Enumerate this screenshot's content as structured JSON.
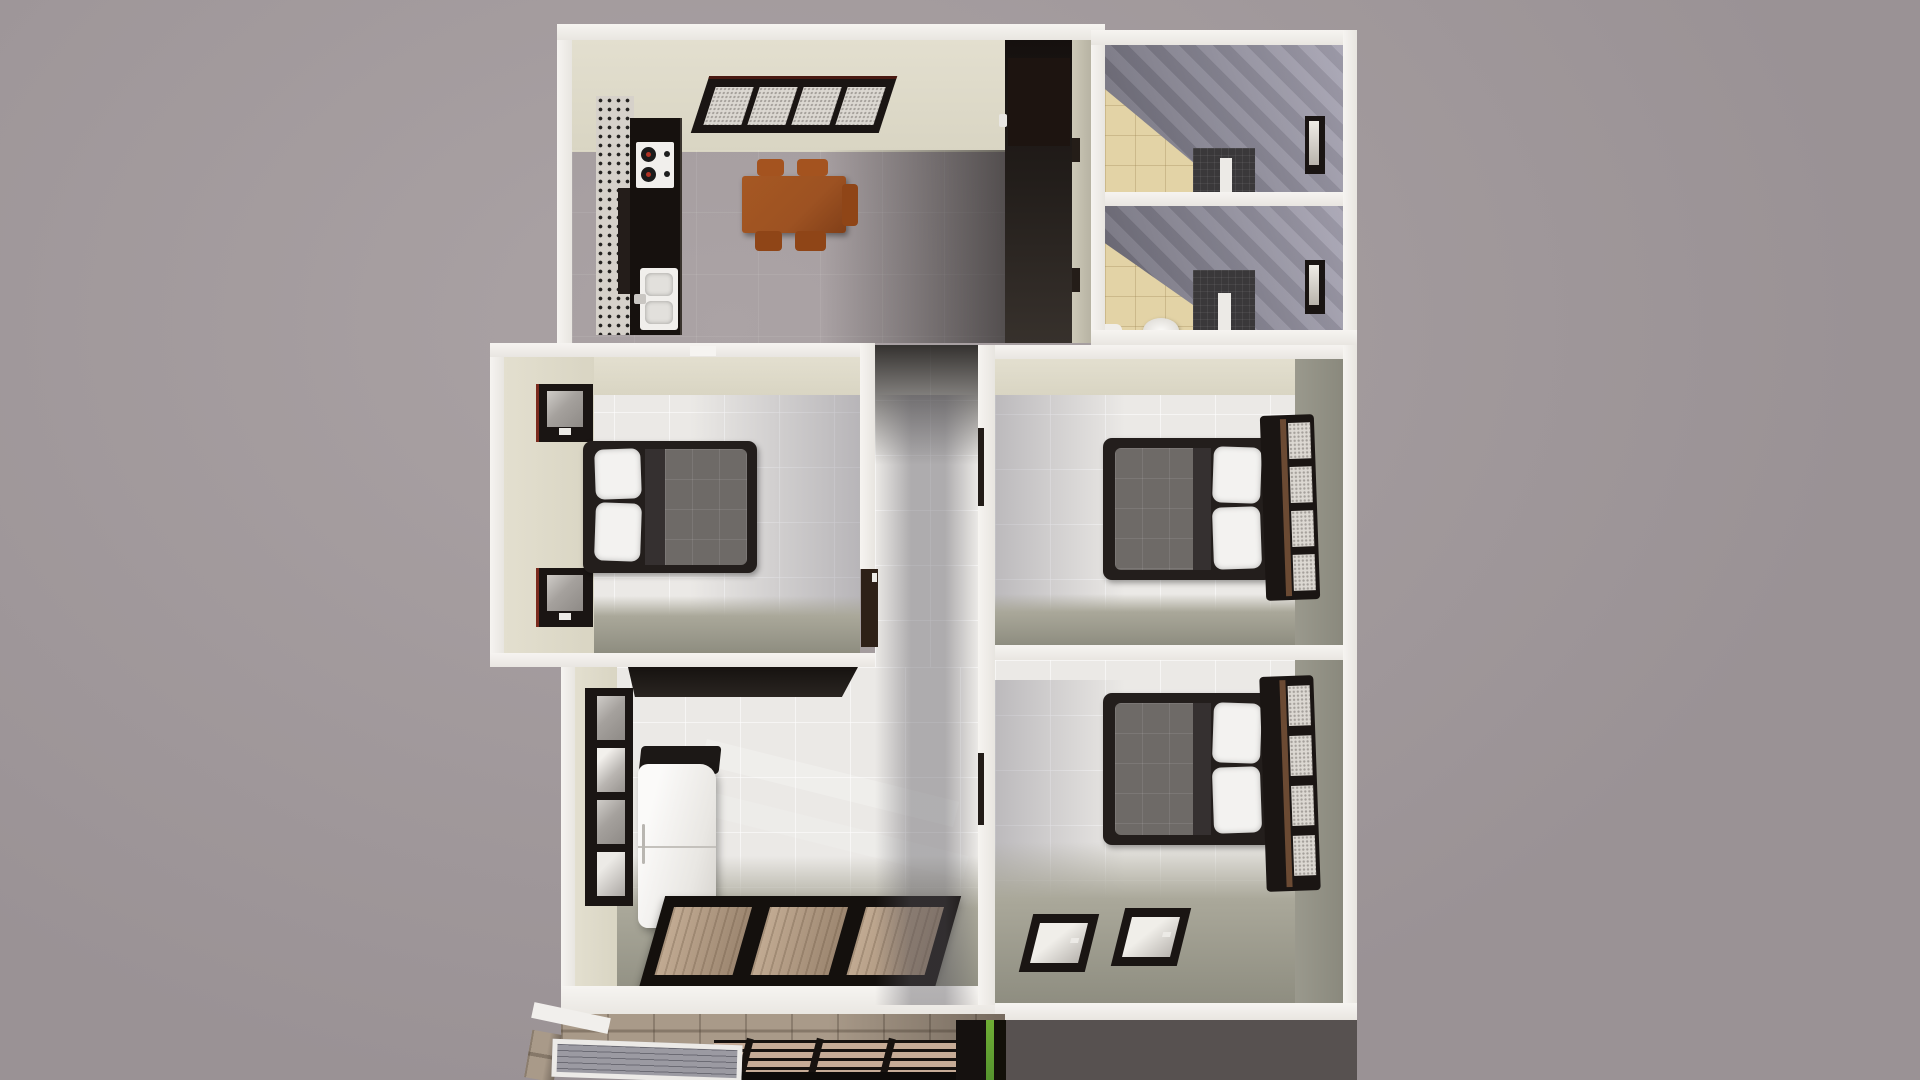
{
  "scene": {
    "view": "top-down 3D dollhouse render of an apartment floor plan",
    "rooms": [
      {
        "name": "kitchen-dining",
        "furniture": [
          "black counter",
          "cooktop with 2 burners",
          "double sink",
          "mosaic backsplash",
          "wood dining table",
          "5 chairs",
          "4-pane north window"
        ]
      },
      {
        "name": "entry-corridor",
        "furniture": [
          "dark entry door with white handle"
        ]
      },
      {
        "name": "bathroom-upper",
        "furniture": [
          "beige tile floor",
          "dark shower tiles",
          "white partition",
          "small east window"
        ]
      },
      {
        "name": "bathroom-lower",
        "furniture": [
          "beige tile floor",
          "dark shower tiles",
          "white partition",
          "toilet",
          "small east window"
        ]
      },
      {
        "name": "bedroom-west",
        "furniture": [
          "double bed with white pillows and gray duvet",
          "two west windows",
          "door to hallway"
        ]
      },
      {
        "name": "hallway",
        "furniture": []
      },
      {
        "name": "bedroom-east-middle",
        "furniture": [
          "double bed",
          "tall 4-pane east window"
        ]
      },
      {
        "name": "bedroom-east-south",
        "furniture": [
          "double bed",
          "tall 4-pane east window",
          "two south windows"
        ]
      },
      {
        "name": "living-room",
        "furniture": [
          "refrigerator",
          "tall west window",
          "black wall shelf",
          "3-panel sliding glass door"
        ]
      }
    ],
    "exterior": [
      "stone base wall",
      "ribbed gray canopy",
      "tan deck with black grille bars",
      "dark concrete slab",
      "green post accent"
    ]
  },
  "colors": {
    "bg1": "#aba3a5",
    "bg2": "#9a9295",
    "wallWhite": "#f3f1ee",
    "innerBeige": "#d9d5c3",
    "innerBeigeLight": "#e3dfcf",
    "oliveWall": "#8a897d",
    "lightFloor": "#ebe9e6",
    "oliveFloor": "#aaa89a",
    "oliveFloorDark": "#8e8d80",
    "bathFloor": "#e3d3a6",
    "showerTile": "#3a383a",
    "frameBlack": "#1a1513",
    "glassSpeck": "#dcd8d2",
    "bedFrame": "#231e1c",
    "duvet": "#6e6a67",
    "pillow": "#f3f2f0",
    "tableWood": "#9d5222",
    "chairWood": "#a4531f",
    "counterBlack": "#16110e",
    "applianceWhite": "#f1efec",
    "burnerRed": "#b03224",
    "corridorDark": "#15100e",
    "doorBrown": "#2e2017",
    "fridgeCap": "#1c1816",
    "shelfBlack": "#161210",
    "stone": "#a99a89",
    "canopy": "#9b9aa2",
    "deckTan": "#c6ab96",
    "slab": "#575150",
    "green": "#55942e"
  }
}
